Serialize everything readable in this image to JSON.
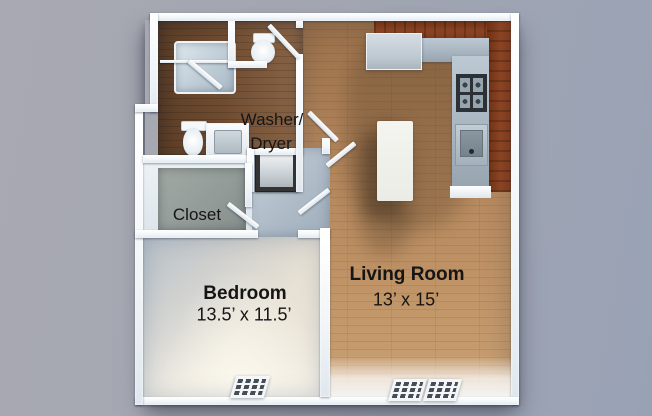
{
  "scene": {
    "type": "3d-floor-plan-top-view",
    "description": "One-bedroom apartment rendered floor plan"
  },
  "labels": {
    "laundry_line1": "Washer/",
    "laundry_line2": "Dryer",
    "closet": "Closet",
    "bedroom_name": "Bedroom",
    "bedroom_dimensions": "13.5’ x 11.5’",
    "living_name": "Living Room",
    "living_dimensions": "13’ x 15’"
  },
  "rooms": [
    {
      "name": "Bedroom",
      "dimensions": "13.5’ x 11.5’"
    },
    {
      "name": "Living Room",
      "dimensions": "13’ x 15’"
    },
    {
      "name": "Closet",
      "dimensions": ""
    },
    {
      "name": "Washer/Dryer",
      "dimensions": ""
    }
  ],
  "fixtures": [
    "bathtub",
    "shower-glass",
    "toilet",
    "toilet",
    "vanity-sink",
    "washer-dryer-unit",
    "refrigerator",
    "stove-cooktop",
    "kitchen-sink",
    "kitchen-cabinets",
    "kitchen-counter",
    "kitchen-island",
    "floor-vent",
    "floor-vent",
    "floor-vent",
    "door-leaf"
  ],
  "colors": {
    "background": "#a3a6b2",
    "walls": "#f7fafc",
    "living_wood_floor": "#b3895e",
    "bathroom_wood_floor": "#6f4e34",
    "bedroom_carpet": "#eae4d8",
    "closet_carpet": "#97a09d",
    "hall_floor": "#b6c2cd",
    "cabinet_wood": "#7e3c1e",
    "countertop": "#a9b6c1",
    "island": "#f0f0ec",
    "label_text": "#151515"
  }
}
